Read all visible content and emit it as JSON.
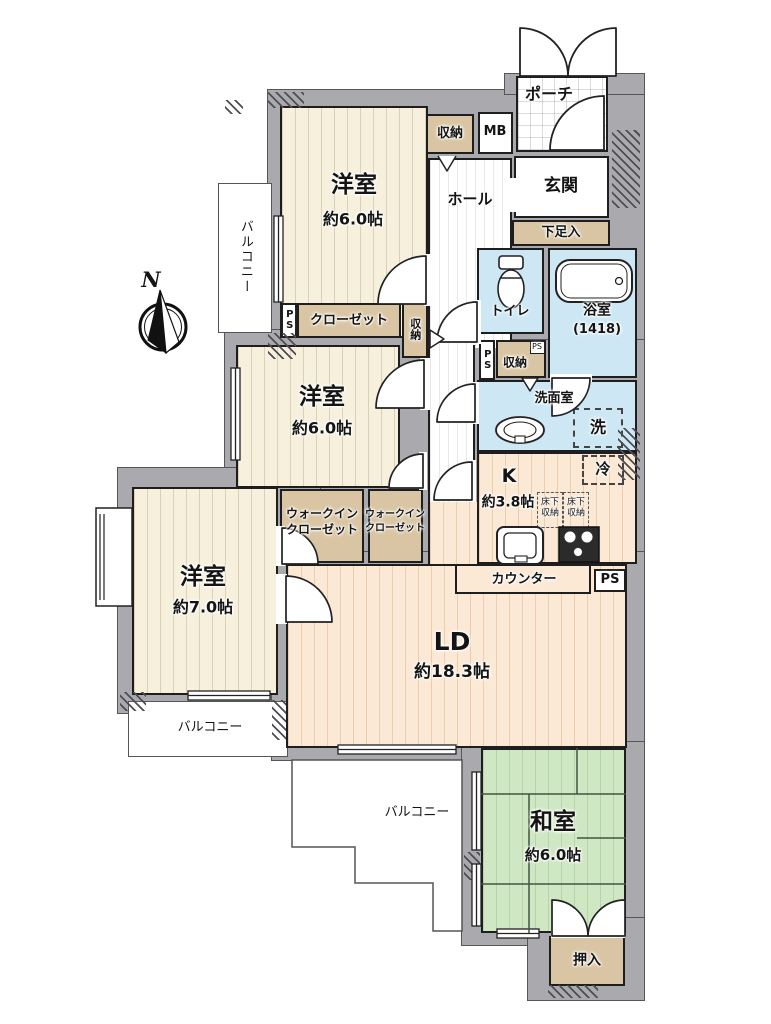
{
  "colors": {
    "wall_gray": "#a9a9ae",
    "western_room_cream": "#f6f0dd",
    "ld_kitchen_peach": "#fbe9d5",
    "japanese_room_green": "#cfe7c3",
    "wet_area_blue": "#cde8f4",
    "storage_tan": "#d9c5a3"
  },
  "compass": {
    "label": "N"
  },
  "rooms": {
    "bedroom_top": {
      "name": "洋室",
      "size": "約6.0帖"
    },
    "bedroom_mid": {
      "name": "洋室",
      "size": "約6.0帖"
    },
    "bedroom_left": {
      "name": "洋室",
      "size": "約7.0帖"
    },
    "living_dining": {
      "name": "LD",
      "size": "約18.3帖"
    },
    "kitchen": {
      "name": "K",
      "size": "約3.8帖"
    },
    "japanese_room": {
      "name": "和室",
      "size": "約6.0帖"
    },
    "entrance": {
      "name": "玄関"
    },
    "hall": {
      "name": "ホール"
    },
    "porch": {
      "name": "ポーチ"
    },
    "toilet": {
      "name": "トイレ"
    },
    "bathroom": {
      "name": "浴室",
      "size": "(1418)"
    },
    "washroom": {
      "name": "洗面室"
    }
  },
  "storage": {
    "closet": "クローゼット",
    "walkin_closet_left": [
      "ウォークイン",
      "クローゼット"
    ],
    "walkin_closet_right": [
      "ウォークイン",
      "クローゼット"
    ],
    "storage_top": "収納",
    "storage_mid": "収納",
    "storage_wash": "収納",
    "shoe_cabinet": "下足入",
    "oshiire": "押入",
    "underfloor_left": [
      "床下",
      "収納"
    ],
    "underfloor_right": [
      "床下",
      "収納"
    ]
  },
  "fixtures": {
    "counter": "カウンター",
    "meter_box": "MB",
    "ps_left": "PS",
    "ps_toilet": "PS",
    "ps_small": "PS",
    "ps_counter": "PS",
    "refrigerator": "冷",
    "washer": "洗"
  },
  "balconies": {
    "left": "バルコニー",
    "bottom_left": "バルコニー",
    "bottom": "バルコニー"
  }
}
